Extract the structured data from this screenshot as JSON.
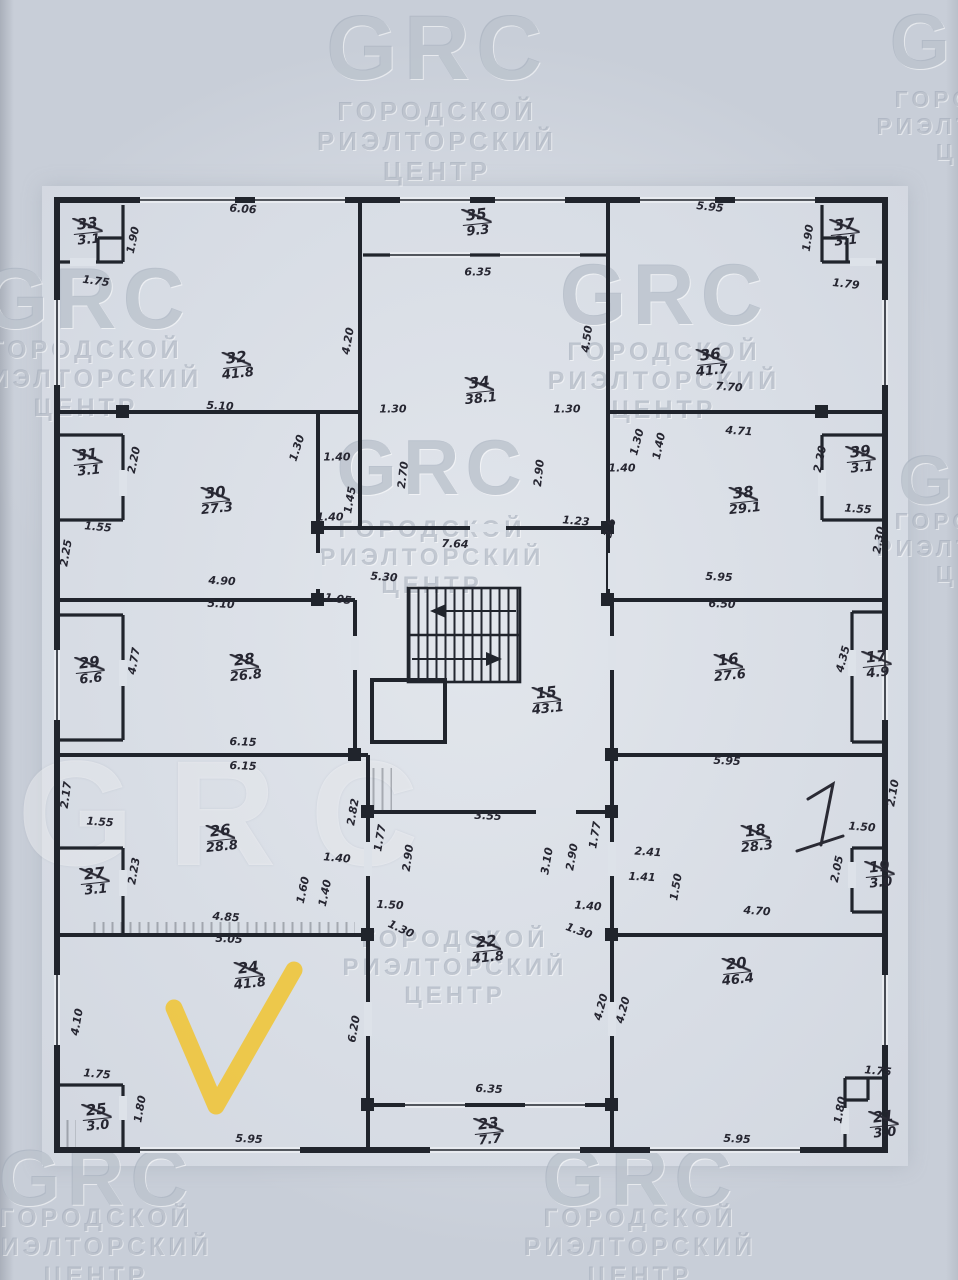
{
  "document": {
    "kind": "scanned floor plan photo"
  },
  "watermark": {
    "logo": "GRC",
    "lines": [
      "ГОРОДСКОЙ",
      "РИЭЛТОРСКИЙ",
      "ЦЕНТР"
    ],
    "instances": [
      {
        "x": 437,
        "ly": 2,
        "ls": 92,
        "ty": 96,
        "fs": 26
      },
      {
        "x": 985,
        "ly": 2,
        "ls": 78,
        "ty": 86,
        "fs": 23
      },
      {
        "x": 86,
        "ly": 256,
        "ls": 86,
        "ty": 336,
        "fs": 25
      },
      {
        "x": 664,
        "ly": 252,
        "ls": 86,
        "ty": 338,
        "fs": 25
      },
      {
        "x": 432,
        "ly": 428,
        "ls": 78,
        "ty": 516,
        "fs": 24
      },
      {
        "x": 985,
        "ly": 445,
        "ls": 70,
        "ty": 508,
        "fs": 23
      },
      {
        "x": 235,
        "ly": 738,
        "ls": 150,
        "ty": 0,
        "fs": 0,
        "giant": true
      },
      {
        "x": 455,
        "ly": 0,
        "ls": 0,
        "ty": 926,
        "fs": 24
      },
      {
        "x": 96,
        "ly": 1138,
        "ls": 80,
        "ty": 1204,
        "fs": 25
      },
      {
        "x": 640,
        "ly": 1138,
        "ls": 80,
        "ty": 1204,
        "fs": 25
      }
    ]
  },
  "plan": {
    "rooms": [
      {
        "n": "33",
        "a": "3.1",
        "x": 88,
        "y": 231
      },
      {
        "n": "32",
        "a": "41.8",
        "x": 237,
        "y": 365
      },
      {
        "n": "35",
        "a": "9.3",
        "x": 477,
        "y": 222
      },
      {
        "n": "34",
        "a": "38.1",
        "x": 480,
        "y": 390
      },
      {
        "n": "36",
        "a": "41.7",
        "x": 711,
        "y": 362
      },
      {
        "n": "37",
        "a": "3.1",
        "x": 845,
        "y": 232
      },
      {
        "n": "31",
        "a": "3.1",
        "x": 88,
        "y": 462
      },
      {
        "n": "30",
        "a": "27.3",
        "x": 216,
        "y": 500
      },
      {
        "n": "38",
        "a": "29.1",
        "x": 744,
        "y": 500
      },
      {
        "n": "39",
        "a": "3.1",
        "x": 861,
        "y": 459
      },
      {
        "n": "29",
        "a": "6.6",
        "x": 90,
        "y": 670
      },
      {
        "n": "28",
        "a": "26.8",
        "x": 245,
        "y": 667
      },
      {
        "n": "15",
        "a": "43.1",
        "x": 547,
        "y": 700
      },
      {
        "n": "16",
        "a": "27.6",
        "x": 729,
        "y": 667
      },
      {
        "n": "17",
        "a": "4.9",
        "x": 877,
        "y": 664
      },
      {
        "n": "26",
        "a": "28.8",
        "x": 221,
        "y": 838
      },
      {
        "n": "27",
        "a": "3.1",
        "x": 95,
        "y": 881
      },
      {
        "n": "18",
        "a": "28.3",
        "x": 756,
        "y": 838
      },
      {
        "n": "19",
        "a": "3.0",
        "x": 880,
        "y": 874
      },
      {
        "n": "25",
        "a": "3.0",
        "x": 97,
        "y": 1117
      },
      {
        "n": "24",
        "a": "41.8",
        "x": 249,
        "y": 975
      },
      {
        "n": "22",
        "a": "41.8",
        "x": 487,
        "y": 949
      },
      {
        "n": "23",
        "a": "7.7",
        "x": 489,
        "y": 1131
      },
      {
        "n": "20",
        "a": "46.4",
        "x": 737,
        "y": 971
      },
      {
        "n": "21",
        "a": "3.0",
        "x": 884,
        "y": 1124
      }
    ],
    "dimensions": [
      {
        "t": "6.06",
        "x": 243,
        "y": 209,
        "r": -4
      },
      {
        "t": "1.90",
        "x": 133,
        "y": 240,
        "r": 78
      },
      {
        "t": "1.75",
        "x": 96,
        "y": 281,
        "r": -8
      },
      {
        "t": "5.95",
        "x": 710,
        "y": 207,
        "r": -6
      },
      {
        "t": "1.90",
        "x": 808,
        "y": 238,
        "r": 82
      },
      {
        "t": "1.79",
        "x": 846,
        "y": 284,
        "r": -6
      },
      {
        "t": "6.35",
        "x": 478,
        "y": 272,
        "r": 0
      },
      {
        "t": "4.20",
        "x": 348,
        "y": 341,
        "r": 80
      },
      {
        "t": "4.50",
        "x": 587,
        "y": 339,
        "r": 82
      },
      {
        "t": "7.70",
        "x": 729,
        "y": 387,
        "r": -4
      },
      {
        "t": "4.71",
        "x": 739,
        "y": 431,
        "r": -4
      },
      {
        "t": "5.10",
        "x": 220,
        "y": 406,
        "r": -3
      },
      {
        "t": "1.30",
        "x": 393,
        "y": 409,
        "r": 0
      },
      {
        "t": "1.30",
        "x": 567,
        "y": 409,
        "r": 0
      },
      {
        "t": "2.70",
        "x": 403,
        "y": 475,
        "r": 83
      },
      {
        "t": "2.90",
        "x": 539,
        "y": 473,
        "r": 84
      },
      {
        "t": "1.30",
        "x": 297,
        "y": 448,
        "r": 72
      },
      {
        "t": "1.40",
        "x": 337,
        "y": 457,
        "r": 0
      },
      {
        "t": "1.45",
        "x": 350,
        "y": 500,
        "r": 80
      },
      {
        "t": "1.40",
        "x": 330,
        "y": 517,
        "r": 0
      },
      {
        "t": "2.20",
        "x": 134,
        "y": 460,
        "r": 78
      },
      {
        "t": "1.55",
        "x": 98,
        "y": 527,
        "r": -5
      },
      {
        "t": "2.25",
        "x": 66,
        "y": 553,
        "r": 80
      },
      {
        "t": "1.30",
        "x": 637,
        "y": 442,
        "r": 75
      },
      {
        "t": "1.40",
        "x": 659,
        "y": 446,
        "r": 78
      },
      {
        "t": "1.40",
        "x": 622,
        "y": 468,
        "r": 0
      },
      {
        "t": "2.20",
        "x": 820,
        "y": 459,
        "r": 78
      },
      {
        "t": "1.55",
        "x": 858,
        "y": 509,
        "r": -4
      },
      {
        "t": "2.30",
        "x": 879,
        "y": 540,
        "r": 80
      },
      {
        "t": "3.6",
        "x": 610,
        "y": 528,
        "r": 75
      },
      {
        "t": "1.23",
        "x": 576,
        "y": 521,
        "r": -5
      },
      {
        "t": "7.64",
        "x": 455,
        "y": 544,
        "r": -2
      },
      {
        "t": "4.90",
        "x": 222,
        "y": 581,
        "r": -3
      },
      {
        "t": "5.10",
        "x": 221,
        "y": 604,
        "r": -3
      },
      {
        "t": "5.30",
        "x": 384,
        "y": 577,
        "r": -4
      },
      {
        "t": "1.05",
        "x": 338,
        "y": 599,
        "r": -8
      },
      {
        "t": "5.95",
        "x": 719,
        "y": 577,
        "r": -3
      },
      {
        "t": "6.50",
        "x": 722,
        "y": 604,
        "r": -2
      },
      {
        "t": "4.77",
        "x": 134,
        "y": 661,
        "r": 80
      },
      {
        "t": "4.35",
        "x": 843,
        "y": 659,
        "r": 75
      },
      {
        "t": "6.15",
        "x": 243,
        "y": 742,
        "r": -2
      },
      {
        "t": "6.15",
        "x": 243,
        "y": 766,
        "r": -2
      },
      {
        "t": "5.95",
        "x": 727,
        "y": 761,
        "r": -3
      },
      {
        "t": "2.17",
        "x": 66,
        "y": 795,
        "r": 82
      },
      {
        "t": "1.55",
        "x": 100,
        "y": 822,
        "r": -4
      },
      {
        "t": "2.23",
        "x": 134,
        "y": 871,
        "r": 80
      },
      {
        "t": "2.82",
        "x": 353,
        "y": 812,
        "r": 80
      },
      {
        "t": "1.77",
        "x": 380,
        "y": 838,
        "r": 80
      },
      {
        "t": "2.90",
        "x": 408,
        "y": 858,
        "r": 82
      },
      {
        "t": "3.55",
        "x": 488,
        "y": 816,
        "r": -3
      },
      {
        "t": "3.10",
        "x": 547,
        "y": 861,
        "r": 80
      },
      {
        "t": "2.90",
        "x": 572,
        "y": 857,
        "r": 80
      },
      {
        "t": "1.77",
        "x": 595,
        "y": 835,
        "r": 80
      },
      {
        "t": "2.41",
        "x": 648,
        "y": 852,
        "r": -4
      },
      {
        "t": "1.41",
        "x": 642,
        "y": 877,
        "r": -3
      },
      {
        "t": "1.50",
        "x": 676,
        "y": 887,
        "r": 80
      },
      {
        "t": "1.50",
        "x": 862,
        "y": 827,
        "r": -4
      },
      {
        "t": "2.10",
        "x": 893,
        "y": 793,
        "r": 80
      },
      {
        "t": "2.05",
        "x": 837,
        "y": 869,
        "r": 78
      },
      {
        "t": "4.70",
        "x": 757,
        "y": 911,
        "r": -4
      },
      {
        "t": "4.85",
        "x": 226,
        "y": 917,
        "r": -4
      },
      {
        "t": "5.05",
        "x": 229,
        "y": 939,
        "r": -3
      },
      {
        "t": "1.40",
        "x": 337,
        "y": 858,
        "r": -5
      },
      {
        "t": "1.60",
        "x": 303,
        "y": 890,
        "r": 78
      },
      {
        "t": "1.40",
        "x": 325,
        "y": 893,
        "r": 78
      },
      {
        "t": "1.50",
        "x": 390,
        "y": 905,
        "r": -3
      },
      {
        "t": "1.30",
        "x": 401,
        "y": 929,
        "r": -25
      },
      {
        "t": "1.40",
        "x": 588,
        "y": 906,
        "r": -4
      },
      {
        "t": "1.30",
        "x": 579,
        "y": 931,
        "r": -20
      },
      {
        "t": "1.75",
        "x": 97,
        "y": 1074,
        "r": -5
      },
      {
        "t": "1.80",
        "x": 140,
        "y": 1109,
        "r": 80
      },
      {
        "t": "4.10",
        "x": 77,
        "y": 1022,
        "r": 80
      },
      {
        "t": "5.95",
        "x": 249,
        "y": 1139,
        "r": -3
      },
      {
        "t": "6.20",
        "x": 354,
        "y": 1029,
        "r": 80
      },
      {
        "t": "6.35",
        "x": 489,
        "y": 1089,
        "r": -3
      },
      {
        "t": "4.20",
        "x": 601,
        "y": 1007,
        "r": 75
      },
      {
        "t": "4.20",
        "x": 623,
        "y": 1010,
        "r": 75
      },
      {
        "t": "5.95",
        "x": 737,
        "y": 1139,
        "r": -3
      },
      {
        "t": "1.75",
        "x": 878,
        "y": 1071,
        "r": -5
      },
      {
        "t": "1.80",
        "x": 840,
        "y": 1110,
        "r": 80
      }
    ]
  },
  "annotations": {
    "check_symbol": "V",
    "check_color": "#EFC63E",
    "handwritten_mark": "1",
    "ink_color": "#2A2A34"
  }
}
